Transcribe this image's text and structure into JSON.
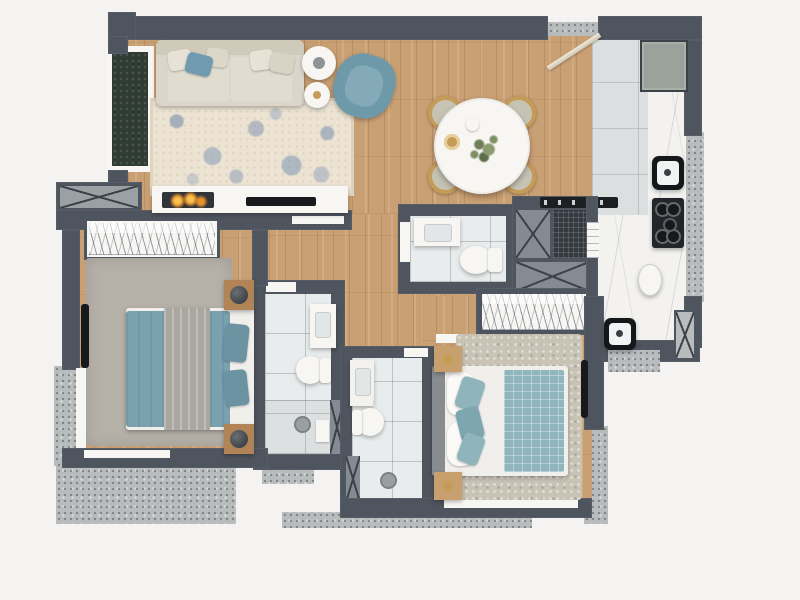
{
  "scene": {
    "type": "floor-plan",
    "description": "Top-down 3D architectural render of a two-bedroom apartment",
    "rendered_text": "none"
  },
  "colors": {
    "background": "#f4f3f1",
    "wall": "#4f555e",
    "wood_floor": "#c99f74",
    "bathroom_tile": "#e9ecec",
    "kitchen_tile": "#dcdfdf",
    "marble_counter": "#f3f2ef",
    "concrete_ledge": "#b9bcbc",
    "accent_teal": "#7aa2ae",
    "sofa_beige": "#dbd6c9",
    "living_rug": "#ece3d2",
    "bedroom1_rug": "#b5b0a8",
    "bedroom2_rug": "#c9c3b6",
    "gold_accent": "#c49c58",
    "fireplace_flame": "#e8912c",
    "shaft_mesh": "#343a40",
    "window_glass": "#2f3c34",
    "appliance_black": "#1c2023",
    "nightstand_wood": "#b08456"
  },
  "rooms": [
    {
      "id": "living-room",
      "furniture": [
        "three-seat-sofa",
        "throw-pillows",
        "round-side-tables",
        "blue-armchair",
        "floral-area-rug",
        "media-console",
        "fireplace",
        "tv",
        "green-window"
      ]
    },
    {
      "id": "dining-area",
      "furniture": [
        "round-dining-table",
        "four-gold-trim-chairs",
        "plant-centerpiece",
        "gold-plate",
        "white-jug"
      ]
    },
    {
      "id": "entry",
      "furniture": [
        "entry-door-swing",
        "threshold"
      ]
    },
    {
      "id": "kitchen",
      "furniture": [
        "refrigerator",
        "marble-counter-l-shape",
        "kitchen-sink",
        "four-burner-cooktop",
        "oval-basin",
        "prep-sink",
        "service-door"
      ]
    },
    {
      "id": "bathroom-1",
      "furniture": [
        "vanity-sink",
        "toilet"
      ]
    },
    {
      "id": "service-shafts",
      "furniture": [
        "x-marked-shaft",
        "mesh-shaft",
        "wide-x-shaft",
        "appliance-strip",
        "shelf-rack"
      ]
    },
    {
      "id": "bedroom-1",
      "furniture": [
        "wardrobe-with-hangers",
        "gray-rug",
        "double-bed-teal-duvet",
        "gray-throw",
        "teal-pillows",
        "two-nightstands",
        "two-ball-lamps",
        "wall-tv",
        "corner-windows"
      ]
    },
    {
      "id": "bathroom-2",
      "furniture": [
        "vanity-sink",
        "toilet",
        "shower-with-drain",
        "shower-shelf"
      ]
    },
    {
      "id": "bathroom-3",
      "furniture": [
        "vanity-sink",
        "toilet",
        "shower-with-drain"
      ]
    },
    {
      "id": "bedroom-2",
      "furniture": [
        "wardrobe-with-hangers",
        "shag-rug",
        "double-bed-white-duvet",
        "teal-quilted-throw",
        "pillows",
        "two-nightstands",
        "two-gold-lamps",
        "wall-tv",
        "bottom-window"
      ]
    }
  ]
}
